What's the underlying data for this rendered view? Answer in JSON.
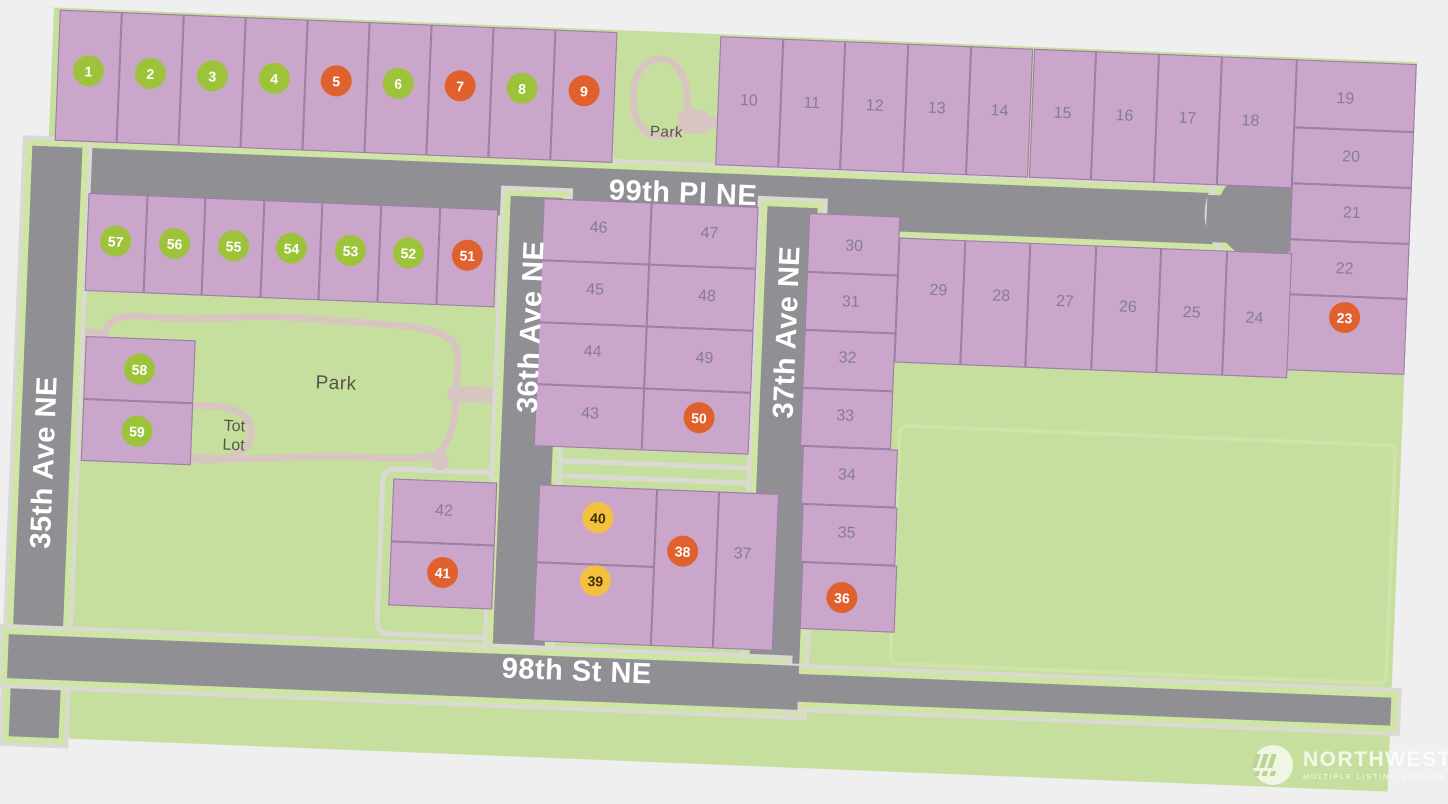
{
  "map": {
    "streets": [
      {
        "name": "99th Pl NE"
      },
      {
        "name": "35th Ave NE"
      },
      {
        "name": "36th Ave NE"
      },
      {
        "name": "37th Ave NE"
      },
      {
        "name": "98th St NE"
      }
    ],
    "park_label": "Park",
    "park_label_top": "Park",
    "tot_lot_lines": [
      "Tot",
      "Lot"
    ],
    "colors": {
      "lot_fill": "#c9a6ca",
      "lot_border": "#997ba4",
      "road": "#909094",
      "green": "#c7df9e",
      "trail": "#d8c5c1",
      "circle_green": "#9cc33a",
      "circle_orange": "#e0612e",
      "circle_yellow": "#f3c13d"
    },
    "lots": [
      {
        "n": "1",
        "c": "green",
        "x": 42,
        "y": 2,
        "w": 62,
        "h": 131,
        "lx": 73,
        "ly": 62
      },
      {
        "n": "2",
        "c": "green",
        "x": 104,
        "y": 2,
        "w": 62,
        "h": 131,
        "lx": 135,
        "ly": 62
      },
      {
        "n": "3",
        "c": "green",
        "x": 166,
        "y": 2,
        "w": 62,
        "h": 131,
        "lx": 197,
        "ly": 62
      },
      {
        "n": "4",
        "c": "green",
        "x": 228,
        "y": 2,
        "w": 62,
        "h": 131,
        "lx": 259,
        "ly": 62
      },
      {
        "n": "5",
        "c": "orange",
        "x": 290,
        "y": 2,
        "w": 62,
        "h": 131,
        "lx": 321,
        "ly": 62
      },
      {
        "n": "6",
        "c": "green",
        "x": 352,
        "y": 2,
        "w": 62,
        "h": 131,
        "lx": 383,
        "ly": 62
      },
      {
        "n": "7",
        "c": "orange",
        "x": 414,
        "y": 2,
        "w": 62,
        "h": 131,
        "lx": 445,
        "ly": 62
      },
      {
        "n": "8",
        "c": "green",
        "x": 476,
        "y": 2,
        "w": 62,
        "h": 131,
        "lx": 507,
        "ly": 62
      },
      {
        "n": "9",
        "c": "orange",
        "x": 538,
        "y": 2,
        "w": 62,
        "h": 131,
        "lx": 569,
        "ly": 62
      },
      {
        "n": "10",
        "c": null,
        "x": 703,
        "y": 2,
        "w": 62.7,
        "h": 129,
        "lx": 734,
        "ly": 66
      },
      {
        "n": "11",
        "c": null,
        "x": 765.7,
        "y": 2,
        "w": 62.7,
        "h": 129,
        "lx": 797,
        "ly": 66
      },
      {
        "n": "12",
        "c": null,
        "x": 828.4,
        "y": 2,
        "w": 62.7,
        "h": 129,
        "lx": 860,
        "ly": 66
      },
      {
        "n": "13",
        "c": null,
        "x": 891.1,
        "y": 2,
        "w": 62.7,
        "h": 129,
        "lx": 922,
        "ly": 66
      },
      {
        "n": "14",
        "c": null,
        "x": 953.8,
        "y": 2,
        "w": 62.7,
        "h": 129,
        "lx": 985,
        "ly": 66
      },
      {
        "n": "15",
        "c": null,
        "x": 1016.5,
        "y": 2,
        "w": 62.7,
        "h": 129,
        "lx": 1048,
        "ly": 66
      },
      {
        "n": "16",
        "c": null,
        "x": 1079.2,
        "y": 2,
        "w": 62.7,
        "h": 129,
        "lx": 1110,
        "ly": 66
      },
      {
        "n": "17",
        "c": null,
        "x": 1141.9,
        "y": 2,
        "w": 62.7,
        "h": 129,
        "lx": 1173,
        "ly": 66
      },
      {
        "n": "18",
        "c": null,
        "x": 1204.6,
        "y": 2,
        "w": 75.4,
        "h": 129,
        "lx": 1236,
        "ly": 66
      },
      {
        "n": "19",
        "c": null,
        "x": 1280,
        "y": 2,
        "w": 120,
        "h": 68,
        "lx": 1330,
        "ly": 40
      },
      {
        "n": "20",
        "c": null,
        "x": 1280,
        "y": 70,
        "w": 120,
        "h": 56,
        "lx": 1338,
        "ly": 98
      },
      {
        "n": "21",
        "c": null,
        "x": 1280,
        "y": 126,
        "w": 120,
        "h": 56,
        "lx": 1341,
        "ly": 154
      },
      {
        "n": "22",
        "c": null,
        "x": 1280,
        "y": 182,
        "w": 120,
        "h": 55,
        "lx": 1336,
        "ly": 210
      },
      {
        "n": "23",
        "c": "orange",
        "x": 1280,
        "y": 237,
        "w": 120,
        "h": 76,
        "lx": 1338,
        "ly": 258
      },
      {
        "n": "24",
        "c": null,
        "x": 1217.5,
        "y": 196,
        "w": 65.5,
        "h": 125,
        "lx": 1248,
        "ly": 263
      },
      {
        "n": "25",
        "c": null,
        "x": 1152,
        "y": 196,
        "w": 65.5,
        "h": 125,
        "lx": 1185,
        "ly": 260
      },
      {
        "n": "26",
        "c": null,
        "x": 1086.5,
        "y": 196,
        "w": 65.5,
        "h": 125,
        "lx": 1121,
        "ly": 257
      },
      {
        "n": "27",
        "c": null,
        "x": 1021,
        "y": 196,
        "w": 65.5,
        "h": 125,
        "lx": 1058,
        "ly": 254
      },
      {
        "n": "28",
        "c": null,
        "x": 955.5,
        "y": 196,
        "w": 65.5,
        "h": 125,
        "lx": 994,
        "ly": 251
      },
      {
        "n": "29",
        "c": null,
        "x": 890,
        "y": 196,
        "w": 65.5,
        "h": 125,
        "lx": 931,
        "ly": 248
      },
      {
        "n": "30",
        "c": null,
        "x": 799,
        "y": 175,
        "w": 91,
        "h": 59,
        "lx": 845,
        "ly": 207
      },
      {
        "n": "31",
        "c": null,
        "x": 799,
        "y": 234,
        "w": 91,
        "h": 58,
        "lx": 844,
        "ly": 263
      },
      {
        "n": "32",
        "c": null,
        "x": 799,
        "y": 292,
        "w": 91,
        "h": 58,
        "lx": 843,
        "ly": 319
      },
      {
        "n": "33",
        "c": null,
        "x": 799,
        "y": 350,
        "w": 91,
        "h": 58,
        "lx": 843,
        "ly": 377
      },
      {
        "n": "34",
        "c": null,
        "x": 802,
        "y": 408,
        "w": 95,
        "h": 58,
        "lx": 847,
        "ly": 436
      },
      {
        "n": "35",
        "c": null,
        "x": 804,
        "y": 466,
        "w": 95,
        "h": 58,
        "lx": 849,
        "ly": 494
      },
      {
        "n": "36",
        "c": "orange",
        "x": 806,
        "y": 524,
        "w": 95,
        "h": 67,
        "lx": 847,
        "ly": 558
      },
      {
        "n": "37",
        "c": null,
        "x": 720,
        "y": 457,
        "w": 60,
        "h": 157,
        "lx": 746,
        "ly": 519
      },
      {
        "n": "38",
        "c": "orange",
        "x": 658,
        "y": 457,
        "w": 62,
        "h": 157,
        "lx": 686,
        "ly": 518
      },
      {
        "n": "39",
        "c": "yellow",
        "x": 540,
        "y": 535,
        "w": 118,
        "h": 79,
        "lx": 600,
        "ly": 551
      },
      {
        "n": "40",
        "c": "yellow",
        "x": 540,
        "y": 457,
        "w": 118,
        "h": 78,
        "lx": 600,
        "ly": 488
      },
      {
        "n": "41",
        "c": "orange",
        "x": 394,
        "y": 520,
        "w": 104,
        "h": 64,
        "lx": 447,
        "ly": 549
      },
      {
        "n": "42",
        "c": null,
        "x": 394,
        "y": 457,
        "w": 104,
        "h": 63,
        "lx": 446,
        "ly": 488
      },
      {
        "n": "43",
        "c": null,
        "x": 533,
        "y": 357,
        "w": 107.5,
        "h": 62,
        "lx": 588,
        "ly": 385
      },
      {
        "n": "44",
        "c": null,
        "x": 533,
        "y": 295,
        "w": 107.5,
        "h": 62,
        "lx": 588,
        "ly": 323
      },
      {
        "n": "45",
        "c": null,
        "x": 533,
        "y": 233,
        "w": 107.5,
        "h": 62,
        "lx": 588,
        "ly": 261
      },
      {
        "n": "46",
        "c": null,
        "x": 533,
        "y": 171,
        "w": 107.5,
        "h": 62,
        "lx": 589,
        "ly": 199
      },
      {
        "n": "47",
        "c": null,
        "x": 640.5,
        "y": 171,
        "w": 107.5,
        "h": 62,
        "lx": 700,
        "ly": 200
      },
      {
        "n": "48",
        "c": null,
        "x": 640.5,
        "y": 233,
        "w": 107.5,
        "h": 62,
        "lx": 700,
        "ly": 263
      },
      {
        "n": "49",
        "c": null,
        "x": 640.5,
        "y": 295,
        "w": 107.5,
        "h": 62,
        "lx": 700,
        "ly": 325
      },
      {
        "n": "50",
        "c": "orange",
        "x": 640.5,
        "y": 357,
        "w": 107.5,
        "h": 62,
        "lx": 697,
        "ly": 384
      },
      {
        "n": "51",
        "c": "orange",
        "x": 429.6,
        "y": 184,
        "w": 58.6,
        "h": 98,
        "lx": 459,
        "ly": 231
      },
      {
        "n": "52",
        "c": "green",
        "x": 371,
        "y": 184,
        "w": 58.6,
        "h": 98,
        "lx": 400,
        "ly": 231
      },
      {
        "n": "53",
        "c": "green",
        "x": 312.4,
        "y": 184,
        "w": 58.6,
        "h": 98,
        "lx": 342,
        "ly": 231
      },
      {
        "n": "54",
        "c": "green",
        "x": 253.8,
        "y": 184,
        "w": 58.6,
        "h": 98,
        "lx": 283,
        "ly": 231
      },
      {
        "n": "55",
        "c": "green",
        "x": 195.2,
        "y": 184,
        "w": 58.6,
        "h": 98,
        "lx": 225,
        "ly": 231
      },
      {
        "n": "56",
        "c": "green",
        "x": 136.6,
        "y": 184,
        "w": 58.6,
        "h": 98,
        "lx": 166,
        "ly": 231
      },
      {
        "n": "57",
        "c": "green",
        "x": 78,
        "y": 184,
        "w": 58.6,
        "h": 98,
        "lx": 107,
        "ly": 231
      },
      {
        "n": "58",
        "c": "green",
        "x": 81,
        "y": 327,
        "w": 110,
        "h": 63,
        "lx": 136,
        "ly": 358
      },
      {
        "n": "59",
        "c": "green",
        "x": 81,
        "y": 390,
        "w": 110,
        "h": 62,
        "lx": 136,
        "ly": 420
      }
    ]
  },
  "watermark": {
    "brand": "NORTHWEST",
    "tagline": "MULTIPLE LISTING SERVICE"
  }
}
